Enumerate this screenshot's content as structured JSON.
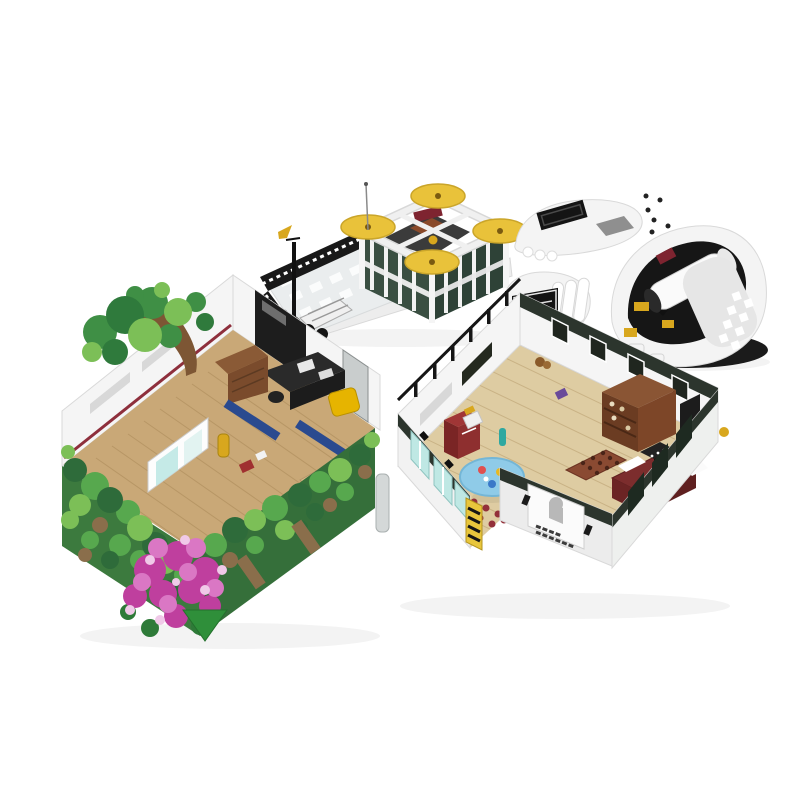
{
  "scene": {
    "background": "#ffffff",
    "sections_total": 4,
    "umbrella_count": 4,
    "white_roof_pieces": 3
  },
  "palette": {
    "background": "#ffffff",
    "umbrella_yellow": "#e9c23a",
    "terrace_rail_black": "#191919",
    "wall_dark_green": "#3a4f42",
    "wall_dark_green_shade": "#2e4237",
    "slab_white": "#ededed",
    "shell_white": "#f4f4f4",
    "vent_black": "#141414",
    "dome_interior_black": "#161616",
    "tank_white": "#fafafa",
    "tank_maroon": "#7e2430",
    "accent_yellow": "#d8a71e",
    "tree_green": "#3f8f45",
    "foliage_light": "#7cbf57",
    "foliage_mid": "#57a84e",
    "foliage_dark": "#2e6b3a",
    "vine_brown": "#8a6e4b",
    "trunk_brown": "#7d5634",
    "flower_magenta": "#bf3f9e",
    "flower_pink": "#da77c4",
    "flower_pale": "#f0c9e8",
    "wood_floor": "#c9a877",
    "plank_tan": "#decca2",
    "cabinet_brown": "#8a5a36",
    "desk_black": "#2a2a2a",
    "armchair_yellow": "#e6b400",
    "awning_blue": "#2a4a8f",
    "glass_teal": "#bfe8e4",
    "rug_red": "#93303a",
    "table_blue": "#8fcbe8",
    "desk_maroon": "#7c2d2d",
    "bookcase_brown": "#6b3c22",
    "parapet_dark": "#2c352d",
    "sign_yellow": "#e8c63c",
    "module_wall_white": "#f5f5f5",
    "baseplate_green": "#2f8f3a"
  }
}
